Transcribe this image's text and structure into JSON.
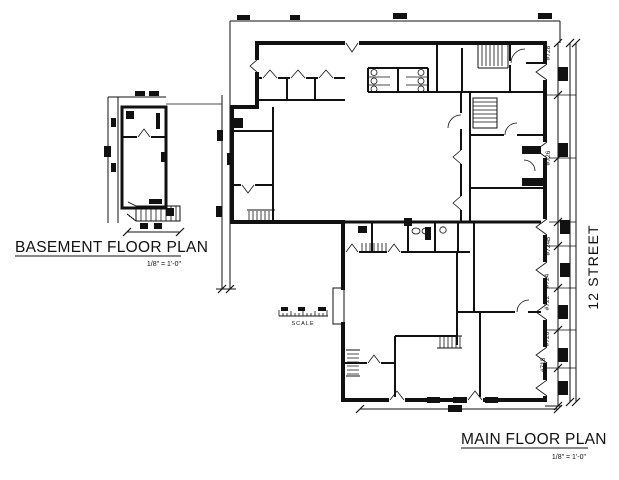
{
  "drawing": {
    "basement": {
      "title": "BASEMENT FLOOR PLAN",
      "scale": "1/8\" = 1'-0\""
    },
    "main": {
      "title": "MAIN FLOOR PLAN",
      "scale": "1/8\" = 1'-0\""
    },
    "street_label": "12 STREET",
    "scale_bar_label": "SCALE",
    "addresses": [
      "#728",
      "#726",
      "#724B",
      "#724",
      "#722",
      "#720",
      "#718"
    ]
  },
  "colors": {
    "ink": "#111111",
    "paper": "#ffffff"
  }
}
